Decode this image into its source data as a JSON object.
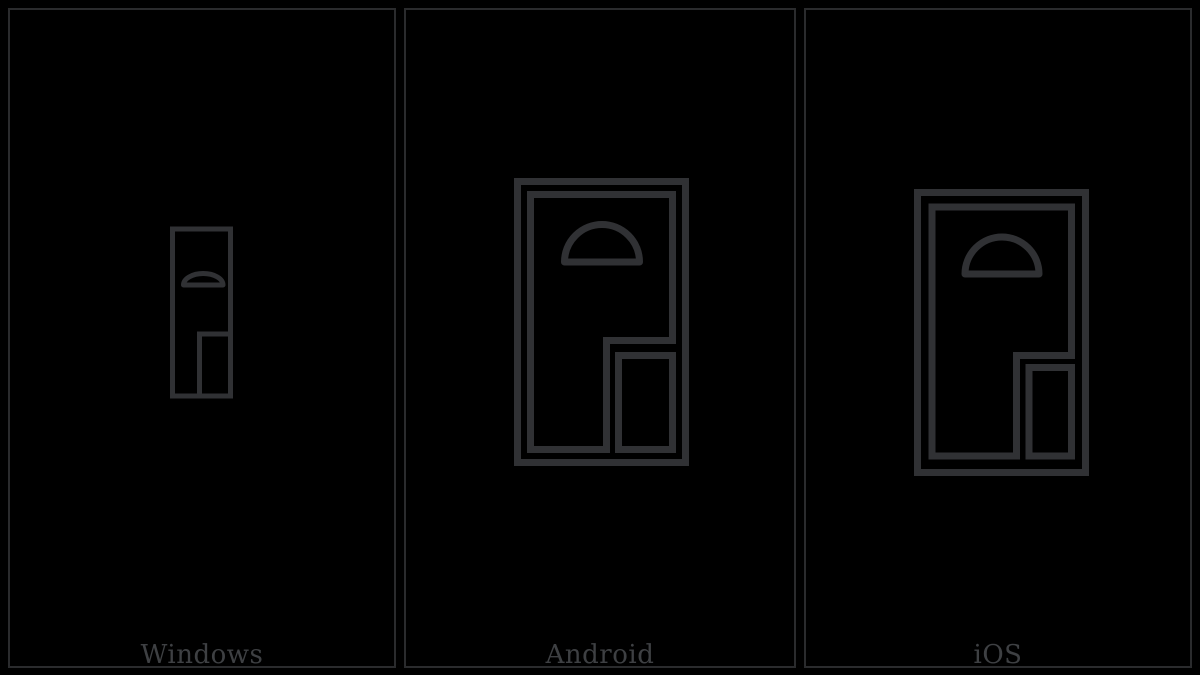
{
  "colors": {
    "background": "#000000",
    "panel_border": "#2a2b2d",
    "glyph_stroke": "#303134",
    "label_text": "#3e4043"
  },
  "panels": [
    {
      "label": "Windows",
      "glyph_icon": "door-glyph"
    },
    {
      "label": "Android",
      "glyph_icon": "door-glyph"
    },
    {
      "label": "iOS",
      "glyph_icon": "door-glyph"
    }
  ]
}
